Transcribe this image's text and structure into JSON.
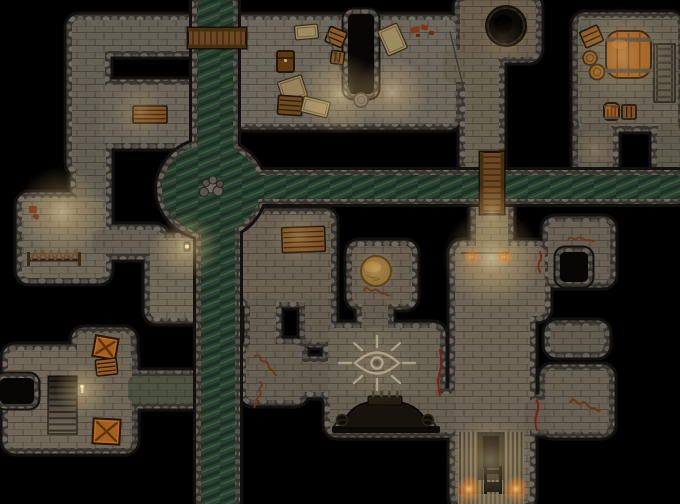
{
  "meta": {
    "label": "dungeon-battlemap",
    "width": 680,
    "height": 504
  },
  "map": {
    "palette": {
      "outline": "#131110",
      "floor": "#6b6459",
      "water_base": "#2b4130",
      "bridge": "#6e4823",
      "eye": "#a79d87",
      "crack": "#7a2013",
      "graffiti": "#6b3617"
    },
    "floors": [
      {
        "name": "corridor-top",
        "x": 72,
        "y": 20,
        "w": 176,
        "h": 31,
        "fill": "#645e54"
      },
      {
        "name": "corridor-west-upper",
        "x": 72,
        "y": 20,
        "w": 33,
        "h": 150,
        "fill": "#645e54"
      },
      {
        "name": "room-storage-nw",
        "x": 100,
        "y": 85,
        "w": 96,
        "h": 58,
        "fill": "#6a6358"
      },
      {
        "name": "corridor-west-mid",
        "x": 76,
        "y": 140,
        "w": 30,
        "h": 85,
        "fill": "#625c52"
      },
      {
        "name": "room-guard-west",
        "x": 22,
        "y": 198,
        "w": 84,
        "h": 80,
        "fill": "#6e6758"
      },
      {
        "name": "corridor-guard-east",
        "x": 92,
        "y": 230,
        "w": 70,
        "h": 24,
        "fill": "#665f54"
      },
      {
        "name": "canal-ledge-west",
        "x": 150,
        "y": 238,
        "w": 50,
        "h": 80,
        "fill": "#6e6857"
      },
      {
        "name": "hall-north",
        "x": 238,
        "y": 20,
        "w": 218,
        "h": 104,
        "fill": "#6d665b"
      },
      {
        "name": "passage-hall-east",
        "x": 443,
        "y": 50,
        "w": 50,
        "h": 32,
        "fill": "#67604f"
      },
      {
        "name": "room-pit",
        "x": 460,
        "y": 0,
        "w": 76,
        "h": 57,
        "fill": "#6a5d4b"
      },
      {
        "name": "corridor-pit-south",
        "x": 465,
        "y": 55,
        "w": 34,
        "h": 116,
        "fill": "#68614f"
      },
      {
        "name": "corridor-bridge-south",
        "x": 476,
        "y": 199,
        "w": 32,
        "h": 54,
        "fill": "#6e6755"
      },
      {
        "name": "room-barrel",
        "x": 578,
        "y": 18,
        "w": 100,
        "h": 108,
        "fill": "#696253"
      },
      {
        "name": "corridor-barrel-south",
        "x": 578,
        "y": 124,
        "w": 35,
        "h": 47,
        "fill": "#635c4e"
      },
      {
        "name": "corridor-barrel-east",
        "x": 657,
        "y": 124,
        "w": 23,
        "h": 47,
        "fill": "#605a4c"
      },
      {
        "name": "room-bench",
        "x": 243,
        "y": 214,
        "w": 88,
        "h": 88,
        "fill": "#696052"
      },
      {
        "name": "passage-bench-sw",
        "x": 250,
        "y": 296,
        "w": 26,
        "h": 54,
        "fill": "#635c4f"
      },
      {
        "name": "room-graffiti",
        "x": 246,
        "y": 344,
        "w": 56,
        "h": 56,
        "fill": "#665f51"
      },
      {
        "name": "passage-graffiti-east",
        "x": 298,
        "y": 362,
        "w": 34,
        "h": 30,
        "fill": "#635c4f"
      },
      {
        "name": "passage-bench-se",
        "x": 305,
        "y": 296,
        "w": 26,
        "h": 46,
        "fill": "#635c4f"
      },
      {
        "name": "room-mound",
        "x": 352,
        "y": 246,
        "w": 60,
        "h": 58,
        "fill": "#6a6052"
      },
      {
        "name": "passage-mound-south",
        "x": 362,
        "y": 300,
        "w": 26,
        "h": 36,
        "fill": "#635c4f"
      },
      {
        "name": "room-eye",
        "x": 328,
        "y": 328,
        "w": 112,
        "h": 74,
        "fill": "#6a6354"
      },
      {
        "name": "hall-altar",
        "x": 330,
        "y": 394,
        "w": 128,
        "h": 38,
        "fill": "#665f51"
      },
      {
        "name": "hall-grand-upper",
        "x": 455,
        "y": 246,
        "w": 90,
        "h": 70,
        "fill": "#6c6355"
      },
      {
        "name": "hall-grand-lower",
        "x": 455,
        "y": 300,
        "w": 75,
        "h": 204,
        "fill": "#6c6355"
      },
      {
        "name": "room-side-east",
        "x": 548,
        "y": 222,
        "w": 62,
        "h": 60,
        "fill": "#676052"
      },
      {
        "name": "alcove-east",
        "x": 550,
        "y": 326,
        "w": 54,
        "h": 26,
        "fill": "#615a4e"
      },
      {
        "name": "room-graffiti-se",
        "x": 545,
        "y": 370,
        "w": 64,
        "h": 62,
        "fill": "#676052"
      },
      {
        "name": "passage-grand-east",
        "x": 524,
        "y": 400,
        "w": 26,
        "h": 30,
        "fill": "#635c4f"
      },
      {
        "name": "room-sw",
        "x": 8,
        "y": 350,
        "w": 124,
        "h": 98,
        "fill": "#6e6556"
      },
      {
        "name": "nook-sw-north",
        "x": 77,
        "y": 333,
        "w": 54,
        "h": 24,
        "fill": "#6a6354"
      },
      {
        "name": "corridor-sw-canal",
        "x": 128,
        "y": 376,
        "w": 74,
        "h": 27,
        "fill": "#4c5140"
      }
    ],
    "voids": [
      {
        "name": "niche-hall",
        "x": 348,
        "y": 14,
        "w": 26,
        "h": 80
      },
      {
        "name": "notch-room-side",
        "x": 560,
        "y": 252,
        "w": 28,
        "h": 30
      },
      {
        "name": "notch-room-sw",
        "x": 0,
        "y": 378,
        "w": 34,
        "h": 26
      }
    ],
    "water": {
      "canal_north": {
        "x": 197,
        "y": 0,
        "w": 36,
        "h": 168
      },
      "canal_south": {
        "x": 201,
        "y": 218,
        "w": 34,
        "h": 286
      },
      "canal_east": {
        "x": 240,
        "y": 175,
        "w": 440,
        "h": 24
      },
      "junction": {
        "cx": 211,
        "cy": 189,
        "rx": 49,
        "ry": 45
      },
      "island_stones": [
        [
          211,
          187,
          6,
          "#6e6860"
        ],
        [
          204,
          192,
          4.5,
          "#57534b"
        ],
        [
          218,
          191,
          5,
          "#635d55"
        ],
        [
          213,
          180,
          4,
          "#5f5a52"
        ],
        [
          220,
          184,
          3.5,
          "#4e4942"
        ],
        [
          206,
          183,
          3.5,
          "#57534b"
        ]
      ]
    },
    "bridges": [
      {
        "name": "bridge-north",
        "x": 188,
        "y": 28,
        "w": 58,
        "h": 20,
        "dir": "h"
      },
      {
        "name": "bridge-east",
        "x": 480,
        "y": 152,
        "w": 24,
        "h": 62,
        "dir": "v"
      }
    ],
    "props": [
      {
        "t": "box",
        "n": "wooden-crate",
        "x": 133,
        "y": 106,
        "w": 34,
        "h": 17,
        "rot": 0,
        "f": "#7a4a1f",
        "slats": 3,
        "dir": "h"
      },
      {
        "t": "flat",
        "n": "table",
        "x": 295,
        "y": 25,
        "w": 23,
        "h": 14,
        "rot": -5,
        "f": "#9c8a60"
      },
      {
        "t": "box",
        "n": "crate",
        "x": 327,
        "y": 29,
        "w": 18,
        "h": 16,
        "rot": 22,
        "f": "#8a5a28",
        "slats": 2,
        "dir": "h"
      },
      {
        "t": "chest",
        "n": "chest",
        "x": 277,
        "y": 51,
        "w": 17,
        "h": 21,
        "f": "#5c3a16"
      },
      {
        "t": "box",
        "n": "small-box",
        "x": 331,
        "y": 51,
        "w": 13,
        "h": 13,
        "rot": 8,
        "f": "#7c5224",
        "slats": 2,
        "dir": "v"
      },
      {
        "t": "flat",
        "n": "crate-tan",
        "x": 280,
        "y": 78,
        "w": 25,
        "h": 22,
        "rot": -18,
        "f": "#96815a"
      },
      {
        "t": "box",
        "n": "crate",
        "x": 278,
        "y": 96,
        "w": 24,
        "h": 19,
        "rot": 4,
        "f": "#6e4a20",
        "slats": 3,
        "dir": "h"
      },
      {
        "t": "flat",
        "n": "floor-mat",
        "x": 302,
        "y": 99,
        "w": 27,
        "h": 16,
        "rot": 14,
        "f": "#9c8a62"
      },
      {
        "t": "flat",
        "n": "table",
        "x": 382,
        "y": 26,
        "w": 21,
        "h": 27,
        "rot": -24,
        "f": "#9c8a60"
      },
      {
        "t": "dots",
        "n": "red-items",
        "items": [
          [
            410,
            27,
            9,
            6,
            -10,
            "#7e3b1c"
          ],
          [
            421,
            25,
            7,
            5,
            15,
            "#8a2e16"
          ],
          [
            429,
            31,
            5,
            4,
            0,
            "#6e2a12"
          ],
          [
            416,
            34,
            4,
            3,
            0,
            "#5e2410"
          ]
        ]
      },
      {
        "t": "rope",
        "n": "rope",
        "x1": 327,
        "y1": 33,
        "x2": 351,
        "y2": 96,
        "c": "#3f3a30",
        "w": 1.5
      },
      {
        "t": "rope",
        "n": "rope",
        "x1": 450,
        "y1": 32,
        "x2": 464,
        "y2": 90,
        "c": "#3f3a30",
        "w": 1.5
      },
      {
        "t": "round",
        "n": "pedestal",
        "cx": 361,
        "cy": 100,
        "r": 7,
        "f": "#6e6960",
        "s": "#3c3832"
      },
      {
        "t": "pit",
        "n": "dark-pit",
        "cx": 506,
        "cy": 26,
        "r": 17
      },
      {
        "t": "box",
        "n": "crate",
        "x": 582,
        "y": 28,
        "w": 19,
        "h": 17,
        "rot": -24,
        "f": "#8a5a28",
        "slats": 2,
        "dir": "h"
      },
      {
        "t": "barrel",
        "n": "barrel-large",
        "x": 606,
        "y": 31,
        "w": 45,
        "h": 47
      },
      {
        "t": "round",
        "n": "pot",
        "cx": 590,
        "cy": 58,
        "r": 7,
        "f": "#8a5a26",
        "s": "#3a2610"
      },
      {
        "t": "round",
        "n": "pot",
        "cx": 597,
        "cy": 72,
        "r": 7.5,
        "f": "#95601f",
        "s": "#3a2610"
      },
      {
        "t": "ladder",
        "n": "stairs-ladder",
        "x": 654,
        "y": 44,
        "w": 21,
        "h": 58,
        "rungs": 8
      },
      {
        "t": "barrel",
        "n": "barrel-small",
        "x": 604,
        "y": 103,
        "w": 15,
        "h": 17
      },
      {
        "t": "box",
        "n": "small-box",
        "x": 622,
        "y": 105,
        "w": 14,
        "h": 14,
        "rot": 0,
        "f": "#7c5224",
        "slats": 2,
        "dir": "v"
      },
      {
        "t": "spikes",
        "n": "spiked-barricade",
        "x": 29,
        "y": 260,
        "len": 50
      },
      {
        "t": "dots",
        "n": "red-marks",
        "items": [
          [
            29,
            206,
            8,
            7,
            0,
            "#6e2a16"
          ],
          [
            33,
            214,
            6,
            5,
            30,
            "#5e2410"
          ]
        ]
      },
      {
        "t": "box",
        "n": "bench",
        "x": 282,
        "y": 227,
        "w": 43,
        "h": 25,
        "rot": -2,
        "f": "#7a4e22",
        "slats": 4,
        "dir": "h"
      },
      {
        "t": "mound",
        "n": "earth-mound",
        "cx": 376,
        "cy": 271,
        "r": 15
      },
      {
        "t": "squiggle",
        "n": "graffiti",
        "x": 364,
        "y": 290,
        "rot": 10,
        "s": 1
      },
      {
        "t": "eye",
        "n": "eye-sigil",
        "cx": 377,
        "cy": 363
      },
      {
        "t": "squiggle",
        "n": "graffiti",
        "x": 255,
        "y": 356,
        "rot": 40,
        "s": 1.1
      },
      {
        "t": "squiggle",
        "n": "graffiti",
        "x": 260,
        "y": 382,
        "rot": 100,
        "s": 1
      },
      {
        "t": "altar",
        "n": "dark-altar",
        "x": 336,
        "y": 402,
        "w": 98
      },
      {
        "t": "stairs",
        "n": "staircase-down",
        "x": 48,
        "y": 376,
        "w": 29,
        "h": 58
      },
      {
        "t": "xcrate",
        "n": "crate-x",
        "x": 94,
        "y": 337,
        "w": 23,
        "h": 21,
        "rot": 10
      },
      {
        "t": "box",
        "n": "crate",
        "x": 96,
        "y": 359,
        "w": 21,
        "h": 16,
        "rot": -6,
        "f": "#9a5c22",
        "slats": 3,
        "dir": "h"
      },
      {
        "t": "xcrate",
        "n": "crate-x",
        "x": 93,
        "y": 419,
        "w": 27,
        "h": 25,
        "rot": 3
      },
      {
        "t": "candle",
        "n": "candle",
        "x": 82,
        "y": 388
      },
      {
        "t": "gstairs",
        "n": "grand-staircase",
        "x": 458,
        "y": 432,
        "w": 66,
        "h": 72
      },
      {
        "t": "rope",
        "n": "door-line",
        "x1": 462,
        "y1": 253,
        "x2": 508,
        "y2": 253,
        "c": "#2c2822",
        "w": 2
      },
      {
        "t": "torch",
        "n": "torch-mark",
        "x": 471,
        "y": 252
      },
      {
        "t": "torch",
        "n": "torch-mark",
        "x": 503,
        "y": 252
      },
      {
        "t": "crack",
        "n": "red-crack",
        "x": 440,
        "y1": 350,
        "y2": 396
      },
      {
        "t": "crack",
        "n": "red-crack",
        "x": 540,
        "y1": 252,
        "y2": 272
      },
      {
        "t": "crack",
        "n": "red-crack",
        "x": 537,
        "y1": 400,
        "y2": 430
      },
      {
        "t": "squiggle",
        "n": "graffiti",
        "x": 568,
        "y": 240,
        "rot": 0,
        "s": 1
      },
      {
        "t": "squiggle",
        "n": "graffiti",
        "x": 570,
        "y": 402,
        "rot": 15,
        "s": 1.2
      },
      {
        "t": "lamp",
        "n": "lantern",
        "x": 184,
        "y": 242
      }
    ],
    "lights": [
      {
        "x": 340,
        "y": 94,
        "r": 42,
        "c": "warm",
        "o": 0.5
      },
      {
        "x": 392,
        "y": 92,
        "r": 36,
        "c": "warm",
        "o": 0.45
      },
      {
        "x": 140,
        "y": 112,
        "r": 30,
        "c": "warm",
        "o": 0.26
      },
      {
        "x": 62,
        "y": 212,
        "r": 46,
        "c": "warm",
        "o": 0.5
      },
      {
        "x": 186,
        "y": 247,
        "r": 33,
        "c": "warm",
        "o": 0.55
      },
      {
        "x": 492,
        "y": 212,
        "r": 27,
        "c": "warm",
        "o": 0.42
      },
      {
        "x": 492,
        "y": 258,
        "r": 50,
        "c": "warm",
        "o": 0.6
      },
      {
        "x": 299,
        "y": 237,
        "r": 30,
        "c": "warm",
        "o": 0.25
      },
      {
        "x": 82,
        "y": 390,
        "r": 27,
        "c": "warm",
        "o": 0.5
      },
      {
        "x": 376,
        "y": 270,
        "r": 22,
        "c": "warm",
        "o": 0.28
      },
      {
        "x": 622,
        "y": 56,
        "r": 48,
        "c": "warm",
        "o": 0.3
      },
      {
        "x": 503,
        "y": 42,
        "r": 24,
        "c": "warm",
        "o": 0.16
      },
      {
        "x": 490,
        "y": 460,
        "r": 44,
        "c": "warm",
        "o": 0.4
      },
      {
        "x": 377,
        "y": 363,
        "r": 42,
        "c": "warm",
        "o": 0.14
      },
      {
        "x": 595,
        "y": 150,
        "r": 20,
        "c": "warm",
        "o": 0.18
      },
      {
        "x": 469,
        "y": 489,
        "r": 14,
        "c": "orange",
        "o": 0.85
      },
      {
        "x": 516,
        "y": 489,
        "r": 14,
        "c": "orange",
        "o": 0.85
      },
      {
        "x": 472,
        "y": 257,
        "r": 10,
        "c": "orange",
        "o": 0.6
      },
      {
        "x": 504,
        "y": 257,
        "r": 10,
        "c": "orange",
        "o": 0.6
      }
    ]
  }
}
